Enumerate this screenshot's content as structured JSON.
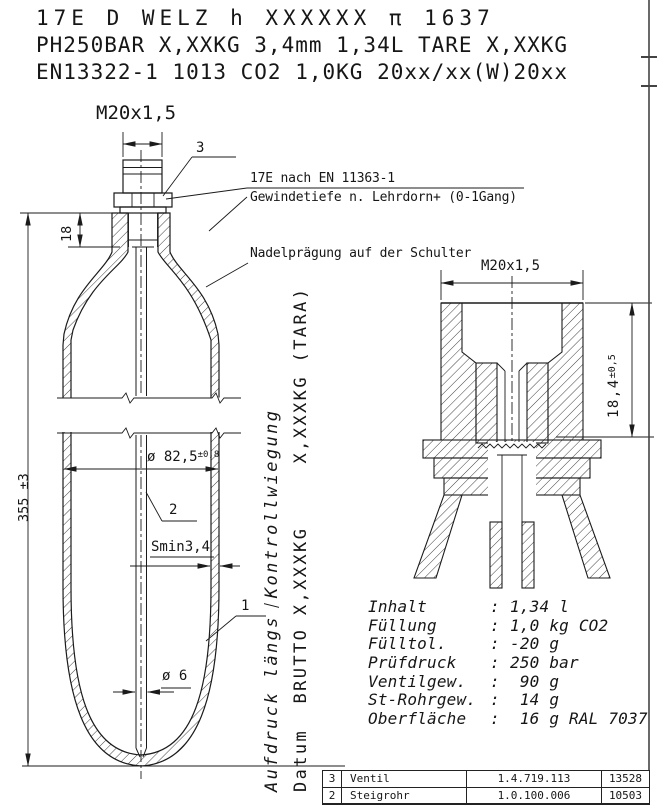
{
  "stamp_header": {
    "line1": "17E D WELZ  h XXXXXX π 1637",
    "line2": "PH250BAR X,XXKG 3,4mm 1,34L TARE X,XXKG",
    "line3": "EN13322-1 1013 CO2 1,0KG 20xx/xx(W)20xx"
  },
  "notes": {
    "thread1": "17E nach EN 11363-1",
    "thread2": "Gewindetiefe n. Lehrdorn+ (0-1Gang)",
    "shoulder": "Nadelprägung auf der Schulter"
  },
  "dims": {
    "m20_main": "M20x1,5",
    "neck_18": "18",
    "total_355": "355 ±3",
    "dia825": "ø 82,5",
    "dia825_tol": "±0,8",
    "smin": "Smin3,4",
    "dia6": "ø 6",
    "m20_detail": "M20x1,5",
    "depth184": "18,4",
    "depth184_tol": "±0,5"
  },
  "callouts": {
    "valve": "3",
    "tube": "2",
    "body": "1"
  },
  "vertical": {
    "aufdruck_a": "Aufdruck längs",
    "aufdruck_b": "Kontrollwiegung",
    "datum": "Datum  BRUTTO X,XXXKG     X,XXXKG (TARA)"
  },
  "specs": {
    "colon": ":",
    "rows": [
      {
        "label": "Inhalt",
        "value": "1,34 l"
      },
      {
        "label": "Füllung",
        "value": "1,0 kg CO2"
      },
      {
        "label": "Fülltol.",
        "value": "-20 g"
      },
      {
        "label": "Prüfdruck",
        "value": "250 bar"
      },
      {
        "label": "Ventilgew.",
        "value": " 90 g"
      },
      {
        "label": "St-Rohrgew.",
        "value": " 14 g"
      },
      {
        "label": "Oberfläche",
        "value": " 16 g RAL 7037"
      }
    ]
  },
  "parts_table": {
    "rows": [
      {
        "pos": "3",
        "name": "Ventil",
        "number": "1.4.719.113",
        "id": "13528"
      },
      {
        "pos": "2",
        "name": "Steigrohr",
        "number": "1.0.100.006",
        "id": "10503"
      }
    ]
  }
}
